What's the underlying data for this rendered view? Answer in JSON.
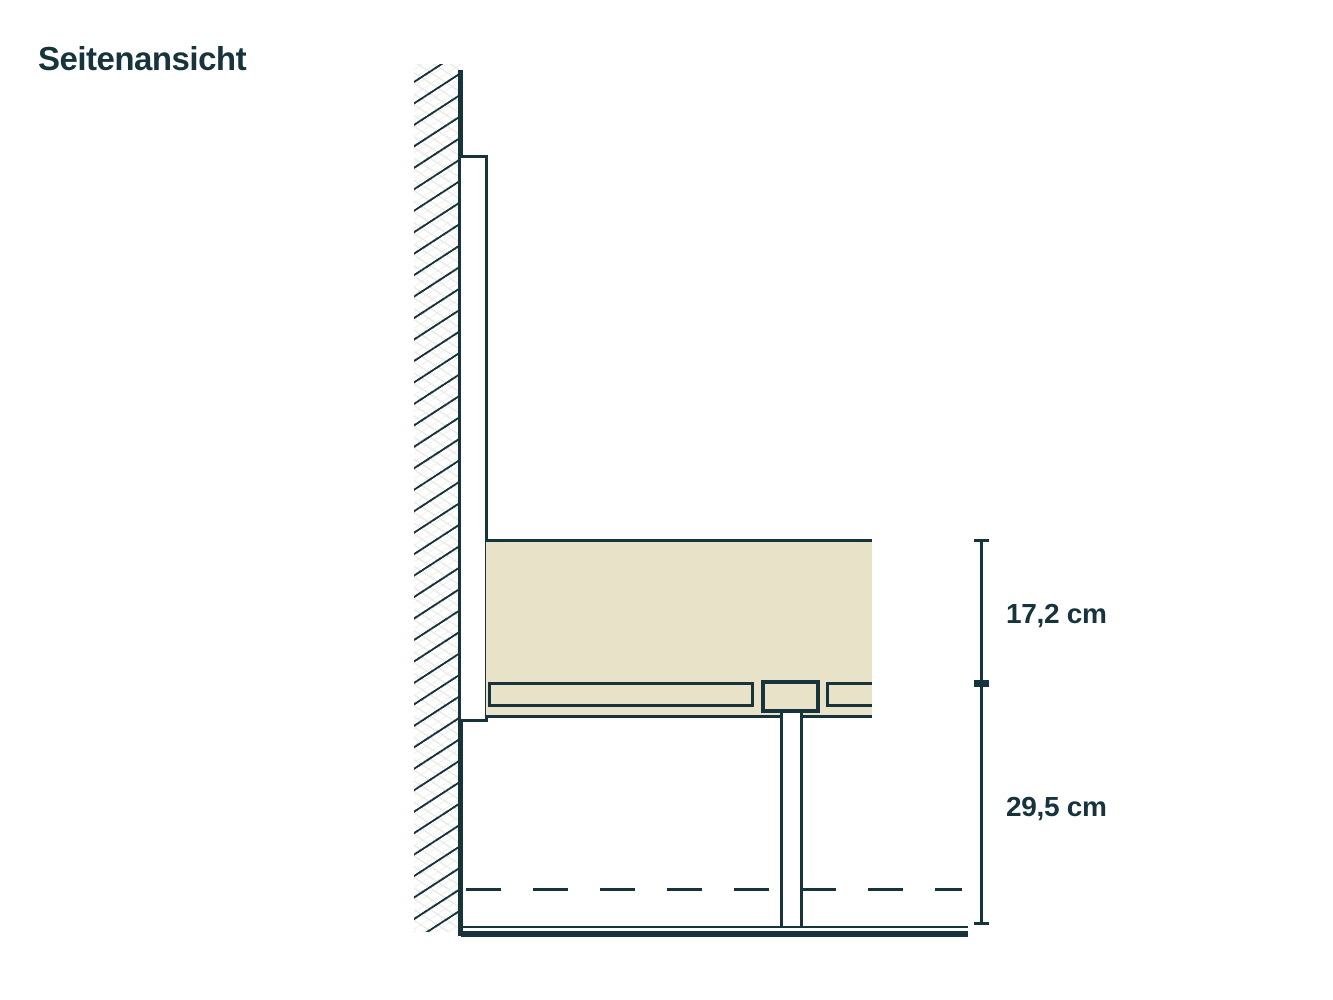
{
  "title": "Seitenansicht",
  "dimensions": {
    "upper_label": "17,2 cm",
    "lower_label": "29,5 cm"
  },
  "colors": {
    "ink": "#17333c",
    "mattress_fill": "#e8e3c8",
    "background": "#ffffff"
  }
}
